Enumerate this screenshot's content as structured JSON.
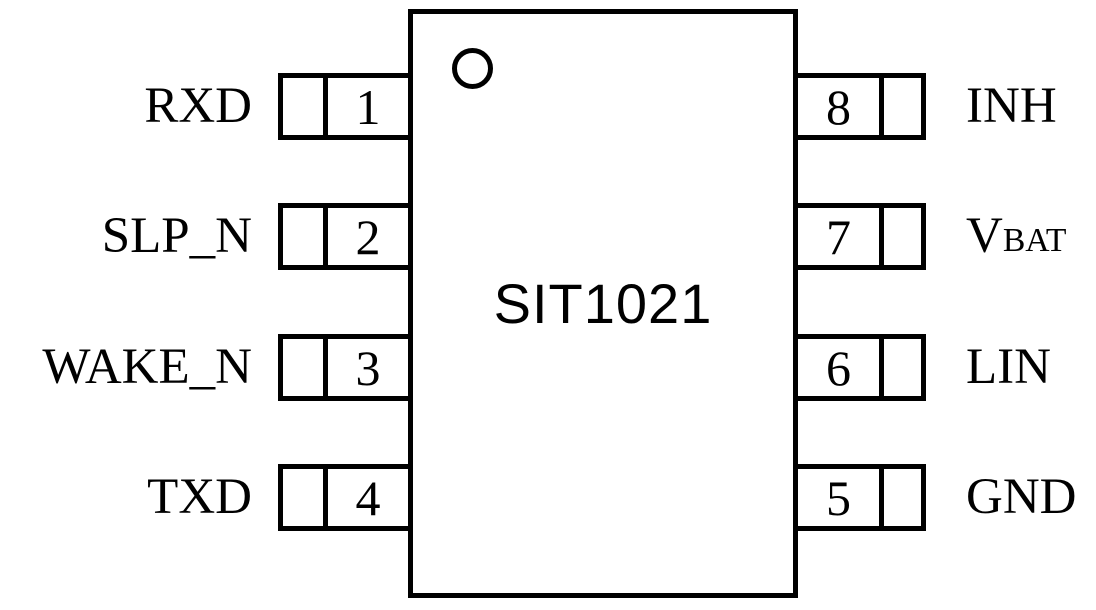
{
  "chip": {
    "name": "SIT1021",
    "package_pin_count": 8,
    "pin1_marker": "circle"
  },
  "pins": {
    "left": [
      {
        "number": "1",
        "name": "RXD"
      },
      {
        "number": "2",
        "name": "SLP_N"
      },
      {
        "number": "3",
        "name": "WAKE_N"
      },
      {
        "number": "4",
        "name": "TXD"
      }
    ],
    "right": [
      {
        "number": "8",
        "name": "INH"
      },
      {
        "number": "7",
        "name": "VBAT",
        "label_base": "V",
        "label_subscript": "BAT"
      },
      {
        "number": "6",
        "name": "LIN"
      },
      {
        "number": "5",
        "name": "GND"
      }
    ]
  },
  "colors": {
    "line": "#000000",
    "text": "#000000",
    "background": "#ffffff"
  }
}
